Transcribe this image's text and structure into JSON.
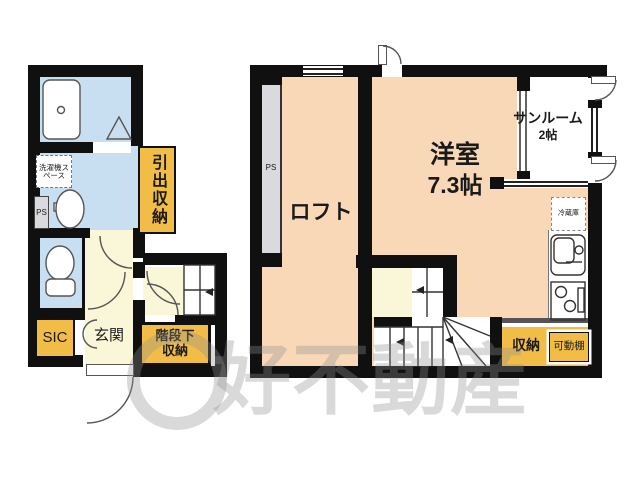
{
  "first_floor": {
    "labels": {
      "laundry_space": "洗濯機スペース",
      "ps": "PS",
      "drawer_storage": "引出収納",
      "sic": "SIC",
      "entrance": "玄関",
      "under_stairs_storage": "階段下収納"
    }
  },
  "second_floor": {
    "labels": {
      "ps": "PS",
      "loft": "ロフト",
      "western_room": "洋室",
      "western_room_size": "7.3帖",
      "sunroom": "サンルーム",
      "sunroom_size": "2帖",
      "refrigerator": "冷蔵庫",
      "storage": "収納",
      "movable_shelf": "可動棚"
    }
  },
  "watermark": "好不動産",
  "colors": {
    "wall": "#101010",
    "wet_room_blue": "#c8dff2",
    "room_peach": "#f8d8b7",
    "hall_pale_yellow": "#faf6d8",
    "storage_orange": "#f1bd47",
    "ps_gray": "#d9d9de"
  }
}
